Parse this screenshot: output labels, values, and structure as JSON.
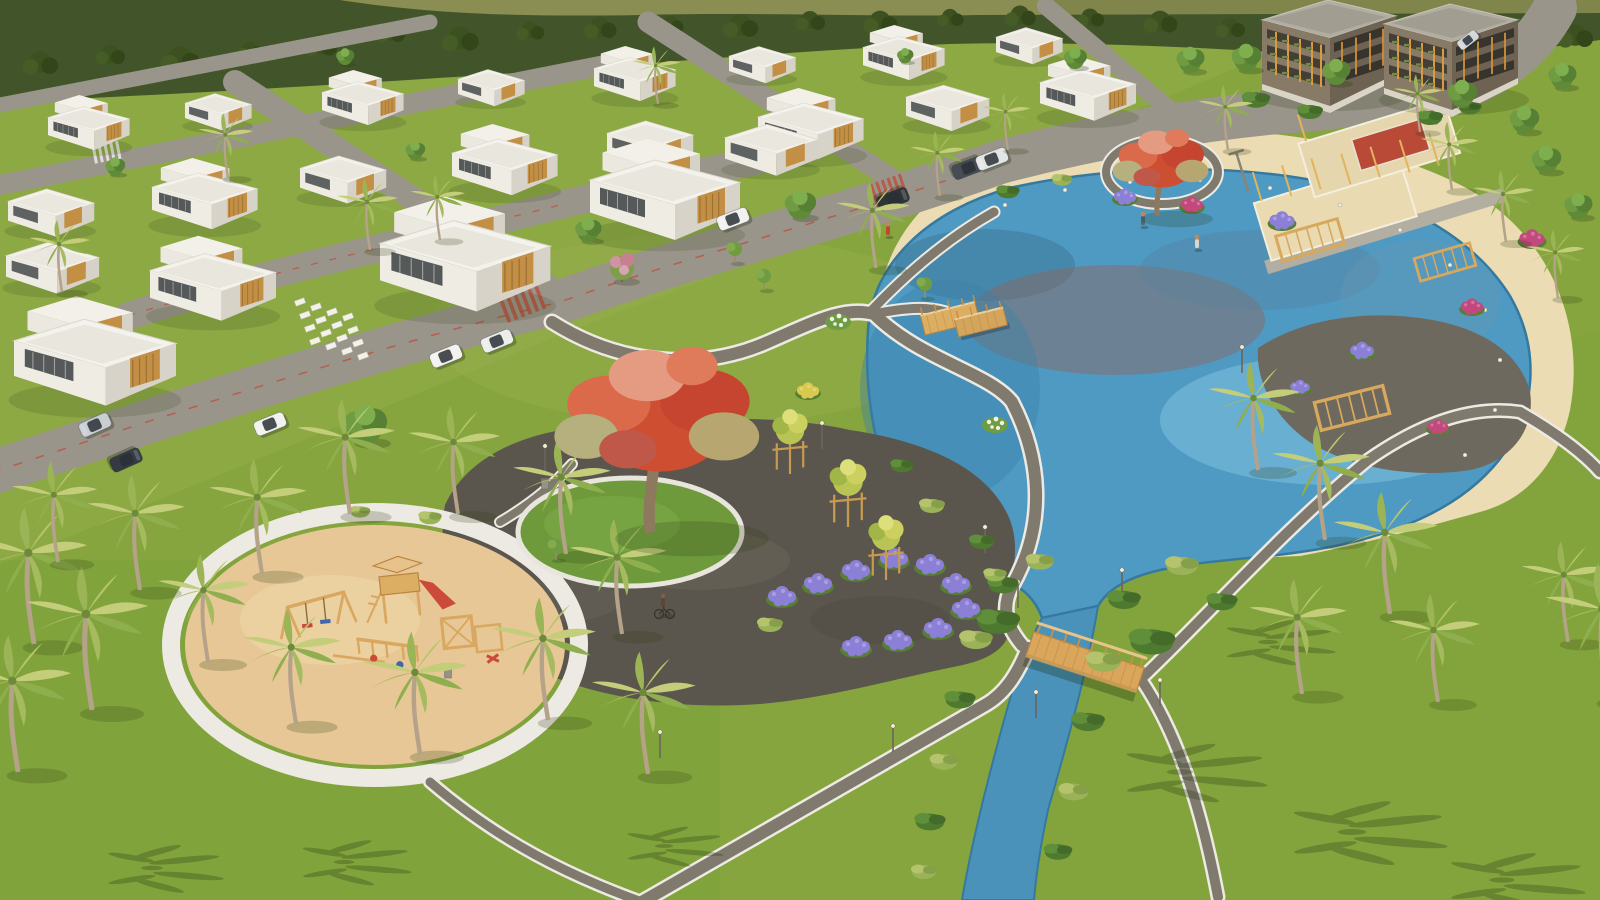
{
  "meta": {
    "scene": "aerial-3d-architectural-render",
    "subject": "master-planned residential community: villa rows, apartment blocks, lagoon lake with beach, central park, sand playground, canal with wooden bridge",
    "no_text_in_image": true,
    "lighting": "sunny daylight, shadows cast to lower-right"
  },
  "palette": {
    "grass": "#86a53e",
    "grassTop": "#93ad48",
    "grassRight": "#7fa439",
    "grassBottom": "#7aa03a",
    "parkLawn": "#97b04d",
    "forest": "#42552a",
    "forestDark": "#33461a",
    "hill": "#8b8e53",
    "hill2": "#7f854b",
    "water": "#4e9ac3",
    "waterLight": "#8ccae4",
    "waterDeep": "#3d80a8",
    "canal": "#4a92ba",
    "waterline": "#35799f",
    "beach": "#ecdcb4",
    "sandPlay": "#e6c795",
    "plaza": "#5b564d",
    "road": "#9a958b",
    "roadDash": "#bf4e3a",
    "path": "#7f7a6d",
    "pathEdge": "#eceae2",
    "circleGrass": "#6e9a3c",
    "ringWhite": "#e8e5dd",
    "flowerPurple": "#8b7fd6",
    "flowerMagenta": "#c2487e",
    "flowerYellow": "#d9c94e",
    "wood": "#d9a65c",
    "woodDark": "#b9853f"
  },
  "scene": {
    "forest_tufts": [
      {
        "x": 40,
        "y": 62,
        "k": 1.2
      },
      {
        "x": 110,
        "y": 54,
        "k": 1.0
      },
      {
        "x": 180,
        "y": 58,
        "k": 1.3
      },
      {
        "x": 250,
        "y": 50,
        "k": 0.9
      },
      {
        "x": 320,
        "y": 44,
        "k": 1.15
      },
      {
        "x": 390,
        "y": 32,
        "k": 1.0
      },
      {
        "x": 460,
        "y": 38,
        "k": 1.25
      },
      {
        "x": 530,
        "y": 30,
        "k": 0.95
      },
      {
        "x": 600,
        "y": 27,
        "k": 1.1
      },
      {
        "x": 670,
        "y": 24,
        "k": 0.9
      },
      {
        "x": 740,
        "y": 25,
        "k": 1.2
      },
      {
        "x": 810,
        "y": 20,
        "k": 1.0
      },
      {
        "x": 880,
        "y": 21,
        "k": 1.15
      },
      {
        "x": 950,
        "y": 17,
        "k": 0.9
      },
      {
        "x": 1020,
        "y": 15,
        "k": 1.05
      },
      {
        "x": 1090,
        "y": 17,
        "k": 0.95
      },
      {
        "x": 1160,
        "y": 21,
        "k": 1.15
      },
      {
        "x": 1230,
        "y": 27,
        "k": 1.0
      },
      {
        "x": 1300,
        "y": 35,
        "k": 1.2
      },
      {
        "x": 1370,
        "y": 41,
        "k": 1.0
      },
      {
        "x": 1440,
        "y": 45,
        "k": 1.25
      },
      {
        "x": 1510,
        "y": 41,
        "k": 1.05
      },
      {
        "x": 1575,
        "y": 35,
        "k": 1.2
      }
    ],
    "houses": [
      {
        "x": 48,
        "y": 112,
        "k": 0.68
      },
      {
        "x": 185,
        "y": 99,
        "k": 0.68,
        "s": "house-b"
      },
      {
        "x": 322,
        "y": 87,
        "k": 0.68
      },
      {
        "x": 458,
        "y": 75,
        "k": 0.68,
        "s": "house-b"
      },
      {
        "x": 594,
        "y": 63,
        "k": 0.68
      },
      {
        "x": 729,
        "y": 52,
        "k": 0.68,
        "s": "house-b"
      },
      {
        "x": 863,
        "y": 42,
        "k": 0.68
      },
      {
        "x": 996,
        "y": 33,
        "k": 0.68,
        "s": "house-b"
      },
      {
        "x": 8,
        "y": 196,
        "k": 0.88,
        "s": "house-b"
      },
      {
        "x": 152,
        "y": 180,
        "k": 0.88
      },
      {
        "x": 300,
        "y": 163,
        "k": 0.88,
        "s": "house-b"
      },
      {
        "x": 452,
        "y": 146,
        "k": 0.88
      },
      {
        "x": 607,
        "y": 128,
        "k": 0.88,
        "s": "house-b"
      },
      {
        "x": 758,
        "y": 110,
        "k": 0.88
      },
      {
        "x": 906,
        "y": 92,
        "k": 0.85,
        "s": "house-b"
      },
      {
        "x": 1040,
        "y": 76,
        "k": 0.8
      },
      {
        "x": 6,
        "y": 250,
        "k": 0.95,
        "s": "house-b"
      },
      {
        "x": 150,
        "y": 262,
        "k": 1.05
      },
      {
        "x": 380,
        "y": 232,
        "k": 1.42,
        "n": "clubhouse"
      },
      {
        "x": 590,
        "y": 170,
        "k": 1.25
      },
      {
        "x": 725,
        "y": 132,
        "k": 0.95,
        "s": "house-b"
      },
      {
        "x": 14,
        "y": 330,
        "k": 1.35,
        "n": "villa-large"
      }
    ],
    "apartments": [
      {
        "x": 1262,
        "y": 18
      },
      {
        "x": 1384,
        "y": 22
      }
    ],
    "cars": [
      {
        "x": 95,
        "y": 425,
        "r": -24,
        "c": "#c9ced2",
        "n": "suv-silver"
      },
      {
        "x": 126,
        "y": 460,
        "r": 156,
        "c": "#343b43",
        "n": "suv-dark"
      },
      {
        "x": 270,
        "y": 424,
        "r": -22,
        "c": "#f1f2f0",
        "n": "car-white"
      },
      {
        "x": 446,
        "y": 356,
        "r": -22,
        "c": "#f3f2ee",
        "n": "suv-white-parked"
      },
      {
        "x": 497,
        "y": 341,
        "r": -22,
        "c": "#eceeec",
        "n": "van-white-parked"
      },
      {
        "x": 733,
        "y": 219,
        "r": -21,
        "c": "#f1f1ef",
        "n": "suv-white"
      },
      {
        "x": 893,
        "y": 199,
        "r": 159,
        "c": "#2e3436",
        "n": "suv-dark"
      },
      {
        "x": 968,
        "y": 168,
        "r": 159,
        "c": "#454c55",
        "n": "sedan-dark"
      },
      {
        "x": 992,
        "y": 159,
        "r": -21,
        "c": "#e3e5e4",
        "n": "sedan-white"
      },
      {
        "x": 1468,
        "y": 40,
        "r": -38,
        "c": "#d5d8da",
        "k": 0.7,
        "n": "car-distant"
      }
    ],
    "people": [
      {
        "x": 888,
        "y": 236,
        "c": "#c2452f",
        "n": "person-red-shirt"
      },
      {
        "x": 1197,
        "y": 249,
        "c": "#ddd5c6",
        "n": "person-on-beach-path"
      },
      {
        "x": 1143,
        "y": 226,
        "c": "#53667a",
        "n": "person-with-stroller"
      }
    ],
    "cyclists": [
      {
        "x": 664,
        "y": 614
      }
    ],
    "palms": [
      {
        "x": 62,
        "y": 292,
        "k": 1.0
      },
      {
        "x": 228,
        "y": 178,
        "k": 0.9
      },
      {
        "x": 370,
        "y": 250,
        "k": 1.0
      },
      {
        "x": 440,
        "y": 240,
        "k": 0.9
      },
      {
        "x": 658,
        "y": 104,
        "k": 0.8
      },
      {
        "x": 876,
        "y": 268,
        "k": 1.2
      },
      {
        "x": 940,
        "y": 196,
        "k": 0.9
      },
      {
        "x": 1008,
        "y": 150,
        "k": 0.8
      },
      {
        "x": 1228,
        "y": 150,
        "k": 0.9
      },
      {
        "x": 1452,
        "y": 190,
        "k": 0.95
      },
      {
        "x": 1506,
        "y": 242,
        "k": 1.0
      },
      {
        "x": 1558,
        "y": 298,
        "k": 0.95
      },
      {
        "x": 34,
        "y": 644,
        "k": 1.9
      },
      {
        "x": 92,
        "y": 710,
        "k": 2.0
      },
      {
        "x": 18,
        "y": 772,
        "k": 1.9
      },
      {
        "x": 140,
        "y": 590,
        "k": 1.6
      },
      {
        "x": 58,
        "y": 562,
        "k": 1.4
      },
      {
        "x": 208,
        "y": 662,
        "k": 1.5
      },
      {
        "x": 262,
        "y": 574,
        "k": 1.6
      },
      {
        "x": 350,
        "y": 514,
        "k": 1.6
      },
      {
        "x": 458,
        "y": 514,
        "k": 1.5
      },
      {
        "x": 566,
        "y": 554,
        "k": 1.6
      },
      {
        "x": 622,
        "y": 634,
        "k": 1.6
      },
      {
        "x": 548,
        "y": 720,
        "k": 1.7
      },
      {
        "x": 420,
        "y": 754,
        "k": 1.7
      },
      {
        "x": 296,
        "y": 724,
        "k": 1.6
      },
      {
        "x": 648,
        "y": 774,
        "k": 1.7
      },
      {
        "x": 1258,
        "y": 470,
        "k": 1.5
      },
      {
        "x": 1325,
        "y": 540,
        "k": 1.6
      },
      {
        "x": 1390,
        "y": 614,
        "k": 1.7
      },
      {
        "x": 1302,
        "y": 694,
        "k": 1.6
      },
      {
        "x": 1438,
        "y": 702,
        "k": 1.5
      },
      {
        "x": 1568,
        "y": 642,
        "k": 1.4
      },
      {
        "x": 1608,
        "y": 700,
        "k": 1.9
      },
      {
        "x": 1420,
        "y": 132,
        "k": 0.8
      }
    ],
    "palm_shadows": [
      {
        "x": 1180,
        "y": 772,
        "k": 2.2
      },
      {
        "x": 1352,
        "y": 832,
        "k": 2.4
      },
      {
        "x": 1502,
        "y": 880,
        "k": 2.1
      },
      {
        "x": 1268,
        "y": 642,
        "k": 1.7
      },
      {
        "x": 152,
        "y": 868,
        "k": 1.8
      },
      {
        "x": 344,
        "y": 862,
        "k": 1.7
      },
      {
        "x": 664,
        "y": 846,
        "k": 1.5
      }
    ],
    "trees": [
      {
        "x": 800,
        "y": 207,
        "k": 0.95
      },
      {
        "x": 1190,
        "y": 62,
        "k": 0.85
      },
      {
        "x": 1246,
        "y": 60,
        "k": 0.9
      },
      {
        "x": 1336,
        "y": 74,
        "k": 0.85
      },
      {
        "x": 1462,
        "y": 96,
        "k": 0.9
      },
      {
        "x": 1524,
        "y": 122,
        "k": 0.9
      },
      {
        "x": 1562,
        "y": 78,
        "k": 0.85
      },
      {
        "x": 1546,
        "y": 162,
        "k": 0.9
      },
      {
        "x": 1578,
        "y": 208,
        "k": 0.85
      },
      {
        "x": 415,
        "y": 152,
        "k": 0.6
      },
      {
        "x": 115,
        "y": 168,
        "k": 0.6
      },
      {
        "x": 345,
        "y": 58,
        "k": 0.55
      },
      {
        "x": 905,
        "y": 57,
        "k": 0.5
      },
      {
        "x": 1075,
        "y": 60,
        "k": 0.7
      },
      {
        "x": 365,
        "y": 428,
        "k": 1.3,
        "n": "large-green-tree"
      },
      {
        "x": 588,
        "y": 232,
        "k": 0.8
      },
      {
        "x": 622,
        "y": 268,
        "k": 1.0,
        "s": "tree-pink",
        "n": "pink-blossom-tree"
      }
    ],
    "small_trees": [
      {
        "x": 735,
        "y": 263
      },
      {
        "x": 764,
        "y": 290
      },
      {
        "x": 658,
        "y": 408
      },
      {
        "x": 925,
        "y": 298
      },
      {
        "x": 556,
        "y": 560
      }
    ],
    "trellis_trees": [
      {
        "x": 790,
        "y": 452,
        "k": 1.1
      },
      {
        "x": 848,
        "y": 504,
        "k": 1.15
      },
      {
        "x": 886,
        "y": 558,
        "k": 1.1
      }
    ],
    "red_trees": [
      {
        "x": 660,
        "y": 430,
        "k": 3.2,
        "n": "flamboyant-tree-main"
      },
      {
        "x": 1162,
        "y": 168,
        "k": 1.5,
        "n": "flamboyant-tree-lakeside"
      }
    ],
    "shrubs": [
      {
        "x": 1003,
        "y": 585,
        "k": 1.2
      },
      {
        "x": 976,
        "y": 640,
        "k": 1.3,
        "s": "shrub-b"
      },
      {
        "x": 960,
        "y": 700,
        "k": 1.2
      },
      {
        "x": 944,
        "y": 762,
        "k": 1.1,
        "s": "shrub-b"
      },
      {
        "x": 930,
        "y": 822,
        "k": 1.2
      },
      {
        "x": 924,
        "y": 872,
        "k": 1.0,
        "s": "shrub-b"
      },
      {
        "x": 1124,
        "y": 600,
        "k": 1.3
      },
      {
        "x": 1104,
        "y": 662,
        "k": 1.4,
        "s": "shrub-b"
      },
      {
        "x": 1088,
        "y": 722,
        "k": 1.3
      },
      {
        "x": 1074,
        "y": 792,
        "k": 1.2,
        "s": "shrub-b"
      },
      {
        "x": 1058,
        "y": 852,
        "k": 1.1
      },
      {
        "x": 1040,
        "y": 562,
        "k": 1.1,
        "s": "shrub-b"
      },
      {
        "x": 982,
        "y": 542,
        "k": 1.0
      },
      {
        "x": 932,
        "y": 506,
        "k": 1.0,
        "s": "shrub-b"
      },
      {
        "x": 902,
        "y": 466,
        "k": 0.9
      },
      {
        "x": 998,
        "y": 622,
        "k": 1.7
      },
      {
        "x": 1152,
        "y": 642,
        "k": 1.8
      },
      {
        "x": 1182,
        "y": 566,
        "k": 1.3,
        "s": "shrub-b"
      },
      {
        "x": 1222,
        "y": 602,
        "k": 1.2
      },
      {
        "x": 1008,
        "y": 192,
        "k": 0.9
      },
      {
        "x": 1062,
        "y": 180,
        "k": 0.8,
        "s": "shrub-b"
      },
      {
        "x": 430,
        "y": 518,
        "k": 0.9,
        "s": "shrub-b"
      },
      {
        "x": 360,
        "y": 512,
        "k": 0.8,
        "s": "shrub-b"
      },
      {
        "x": 770,
        "y": 625,
        "k": 1.0,
        "s": "shrub-b"
      },
      {
        "x": 995,
        "y": 575,
        "k": 0.9,
        "s": "shrub-b"
      },
      {
        "x": 1256,
        "y": 100,
        "k": 1.1
      },
      {
        "x": 1310,
        "y": 112,
        "k": 1.0
      },
      {
        "x": 1430,
        "y": 118,
        "k": 1.0
      },
      {
        "x": 1470,
        "y": 108,
        "k": 0.9
      }
    ],
    "white_shrubs": [
      {
        "x": 838,
        "y": 322
      },
      {
        "x": 995,
        "y": 425
      }
    ],
    "flowers_purple": [
      {
        "x": 782,
        "y": 598
      },
      {
        "x": 818,
        "y": 585
      },
      {
        "x": 856,
        "y": 572
      },
      {
        "x": 894,
        "y": 560
      },
      {
        "x": 930,
        "y": 566
      },
      {
        "x": 956,
        "y": 585
      },
      {
        "x": 966,
        "y": 610
      },
      {
        "x": 938,
        "y": 630
      },
      {
        "x": 898,
        "y": 642
      },
      {
        "x": 856,
        "y": 648
      },
      {
        "x": 1125,
        "y": 198,
        "k": 0.8
      },
      {
        "x": 1282,
        "y": 222,
        "k": 0.9
      },
      {
        "x": 1362,
        "y": 352,
        "k": 0.85
      },
      {
        "x": 1300,
        "y": 388,
        "k": 0.7
      }
    ],
    "flowers_magenta": [
      {
        "x": 1192,
        "y": 206,
        "k": 0.8
      },
      {
        "x": 1532,
        "y": 240,
        "k": 0.9
      },
      {
        "x": 1472,
        "y": 308,
        "k": 0.8
      },
      {
        "x": 1438,
        "y": 428,
        "k": 0.75
      }
    ],
    "flowers_yellow": [
      {
        "x": 808,
        "y": 392,
        "k": 0.8
      }
    ],
    "pergolas": [
      {
        "x": 1310,
        "y": 240,
        "r": -16
      },
      {
        "x": 1445,
        "y": 262,
        "r": -16,
        "k": 0.9
      },
      {
        "x": 1352,
        "y": 408,
        "r": -14,
        "k": 1.1
      }
    ],
    "bollards": [
      {
        "x": 1005,
        "y": 205
      },
      {
        "x": 1065,
        "y": 190
      },
      {
        "x": 1130,
        "y": 182
      },
      {
        "x": 1200,
        "y": 180
      },
      {
        "x": 1270,
        "y": 188
      },
      {
        "x": 1340,
        "y": 205
      },
      {
        "x": 1400,
        "y": 230
      },
      {
        "x": 1450,
        "y": 265
      },
      {
        "x": 1485,
        "y": 310
      },
      {
        "x": 1500,
        "y": 360
      },
      {
        "x": 1495,
        "y": 410
      },
      {
        "x": 1465,
        "y": 455
      }
    ],
    "slabs": [
      {
        "x": 300,
        "y": 302,
        "r": -20
      },
      {
        "x": 316,
        "y": 307,
        "r": -20
      },
      {
        "x": 332,
        "y": 312,
        "r": -20
      },
      {
        "x": 348,
        "y": 317,
        "r": -20
      },
      {
        "x": 305,
        "y": 315,
        "r": -20
      },
      {
        "x": 321,
        "y": 320,
        "r": -20
      },
      {
        "x": 337,
        "y": 325,
        "r": -20
      },
      {
        "x": 353,
        "y": 330,
        "r": -20
      },
      {
        "x": 310,
        "y": 328,
        "r": -20
      },
      {
        "x": 326,
        "y": 333,
        "r": -20
      },
      {
        "x": 342,
        "y": 338,
        "r": -20
      },
      {
        "x": 358,
        "y": 343,
        "r": -20
      },
      {
        "x": 315,
        "y": 341,
        "r": -20
      },
      {
        "x": 331,
        "y": 346,
        "r": -20
      },
      {
        "x": 347,
        "y": 351,
        "r": -20
      },
      {
        "x": 363,
        "y": 356,
        "r": -20
      }
    ],
    "lamps": [
      {
        "x": 985,
        "y": 553
      },
      {
        "x": 893,
        "y": 752
      },
      {
        "x": 822,
        "y": 449
      },
      {
        "x": 1242,
        "y": 373
      },
      {
        "x": 1018,
        "y": 608
      },
      {
        "x": 1122,
        "y": 596
      },
      {
        "x": 1036,
        "y": 718
      },
      {
        "x": 1160,
        "y": 706
      },
      {
        "x": 660,
        "y": 758
      },
      {
        "x": 545,
        "y": 472
      }
    ],
    "bins": [
      {
        "x": 545,
        "y": 489
      },
      {
        "x": 448,
        "y": 678
      }
    ]
  }
}
